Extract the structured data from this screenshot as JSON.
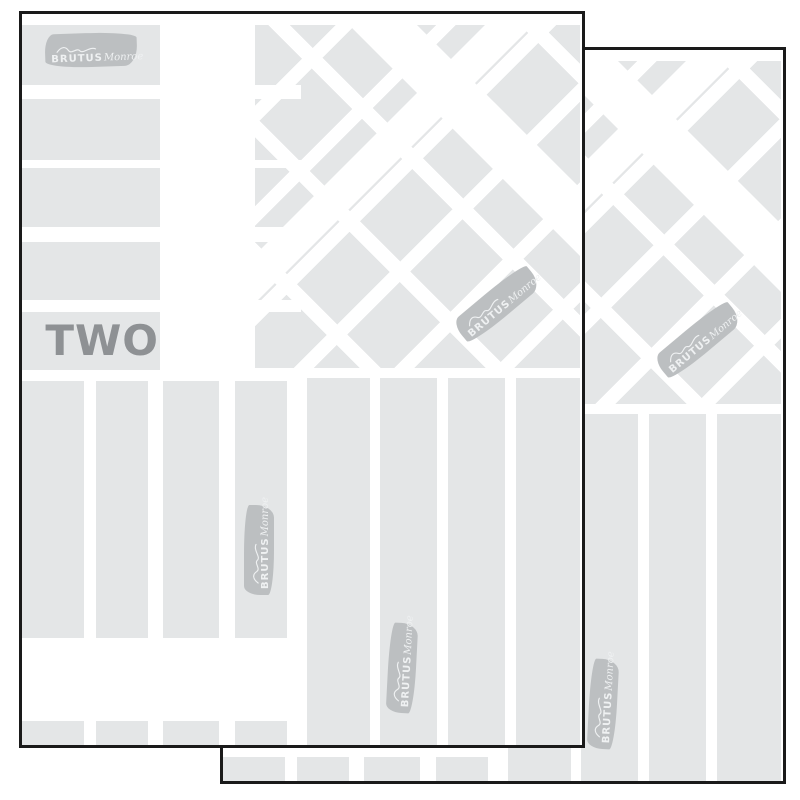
{
  "colors": {
    "canvas": "#ffffff",
    "paper": "#ffffff",
    "block": "#e4e6e7",
    "sheetBorder": "#1a1a1a",
    "stamp": "#bcbfc1",
    "stampText": "#eff1f2",
    "label": "#8e9194"
  },
  "sheet": {
    "pageLabel": "TWO",
    "stampBrand": "BRUTUS",
    "stampScript": "Monroe"
  }
}
